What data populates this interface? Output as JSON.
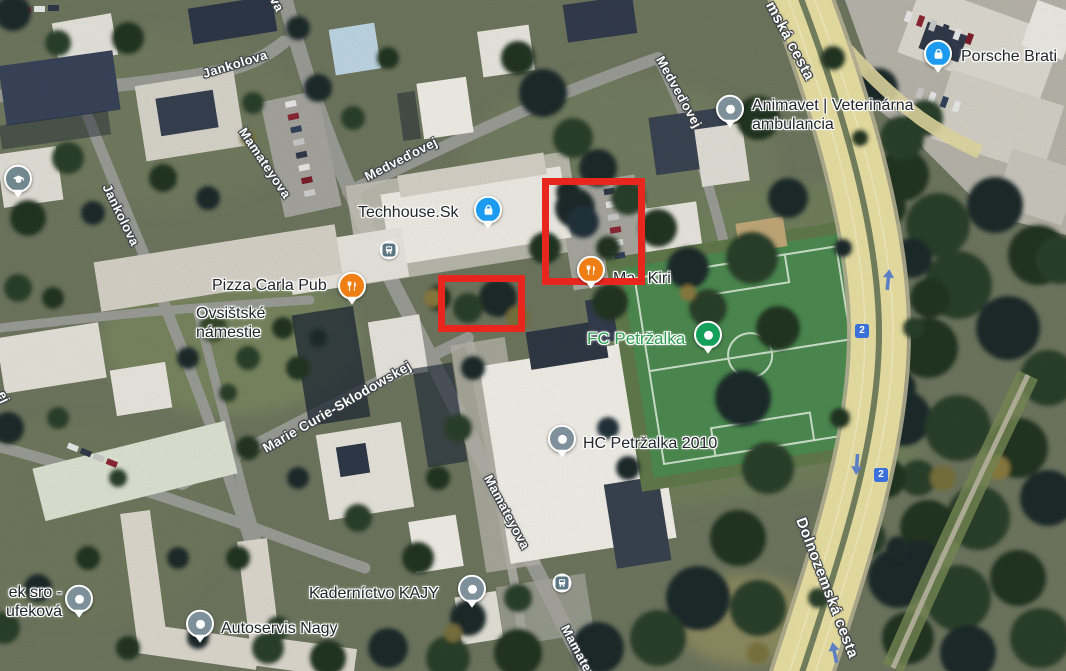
{
  "title": "Satellite map — Petržalka, Bratislava",
  "streets": [
    {
      "name": "Jankolova"
    },
    {
      "name": "Jankolova"
    },
    {
      "name": "Mamateyova"
    },
    {
      "name": "Medveďovej"
    },
    {
      "name": "Medveďovej"
    },
    {
      "name": "Marie Curie-Sklodowskej"
    },
    {
      "name": "Mamateyova"
    },
    {
      "name": "Mamateyova"
    },
    {
      "name": "Dolnozemská cesta"
    },
    {
      "name": "mská cesta"
    },
    {
      "name": "va"
    },
    {
      "name": "ej"
    }
  ],
  "places": [
    {
      "name": "Techhouse.Sk",
      "category": "shopping"
    },
    {
      "name": "Pizza Carla Pub",
      "category": "restaurant"
    },
    {
      "name": "Ma i Kiri",
      "category": "restaurant"
    },
    {
      "line1": "Animavet | Veterinárna",
      "line2": "ambulancia",
      "category": "veterinary"
    },
    {
      "name": "Porsche Brati",
      "category": "shopping"
    },
    {
      "name": "FC Petržalka",
      "category": "sports"
    },
    {
      "name": "HC Petržalka 2010",
      "category": "sports"
    },
    {
      "name": "Kaderníctvo KAJY",
      "category": "services"
    },
    {
      "name": "Autoservis Nagy",
      "category": "services"
    },
    {
      "line1": "ek sro -",
      "line2": "ufeková",
      "category": "services"
    },
    {
      "line1": "Ovsištské",
      "line2": "námestie",
      "category": "area"
    }
  ],
  "route_badges": [
    {
      "label": "2"
    },
    {
      "label": "2"
    }
  ],
  "annotations": {
    "color": "#e8261e",
    "rectangles": [
      {
        "x": 542,
        "y": 178,
        "w": 103,
        "h": 107
      },
      {
        "x": 438,
        "y": 275,
        "w": 87,
        "h": 57
      }
    ]
  },
  "colors": {
    "shopping_pin": "#1d9bf0",
    "restaurant_pin": "#ef7e14",
    "generic_pin": "#7e909a",
    "sports_pin": "#14a05a",
    "education_pin": "#72888f",
    "transit_icon": "#5d7684",
    "route_badge": "#3a70d9",
    "street_label": "#ffffff",
    "poi_label": "#23262b",
    "fc_label": "#2f9e52",
    "annotation_red": "#e8261e"
  }
}
